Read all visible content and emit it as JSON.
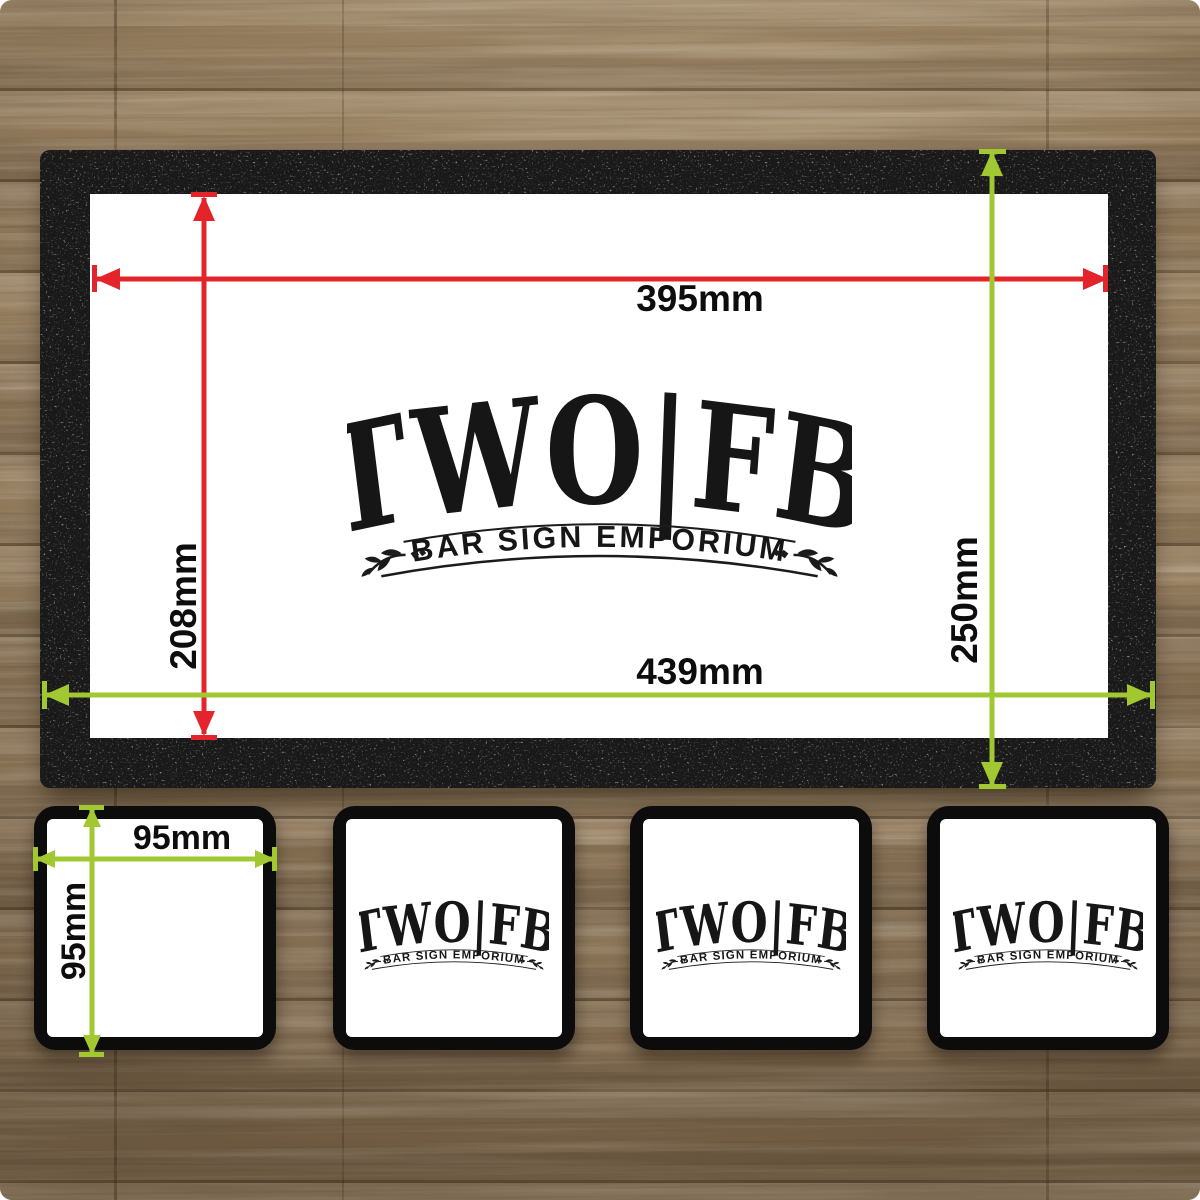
{
  "logo": {
    "title": "TWO|FB",
    "subtitle": "BAR SIGN EMPORIUM"
  },
  "bar_runner": {
    "inner_width_label": "395mm",
    "inner_height_label": "208mm",
    "outer_width_label": "439mm",
    "outer_height_label": "250mm"
  },
  "coaster": {
    "width_label": "95mm",
    "height_label": "95mm"
  },
  "colors": {
    "inner_dimension": "#e3242b",
    "outer_dimension": "#a2c831",
    "mat_black": "#191919",
    "coaster_black": "#0c0c0c",
    "logo_ink": "#161616",
    "wood_base": "#9c8566"
  }
}
